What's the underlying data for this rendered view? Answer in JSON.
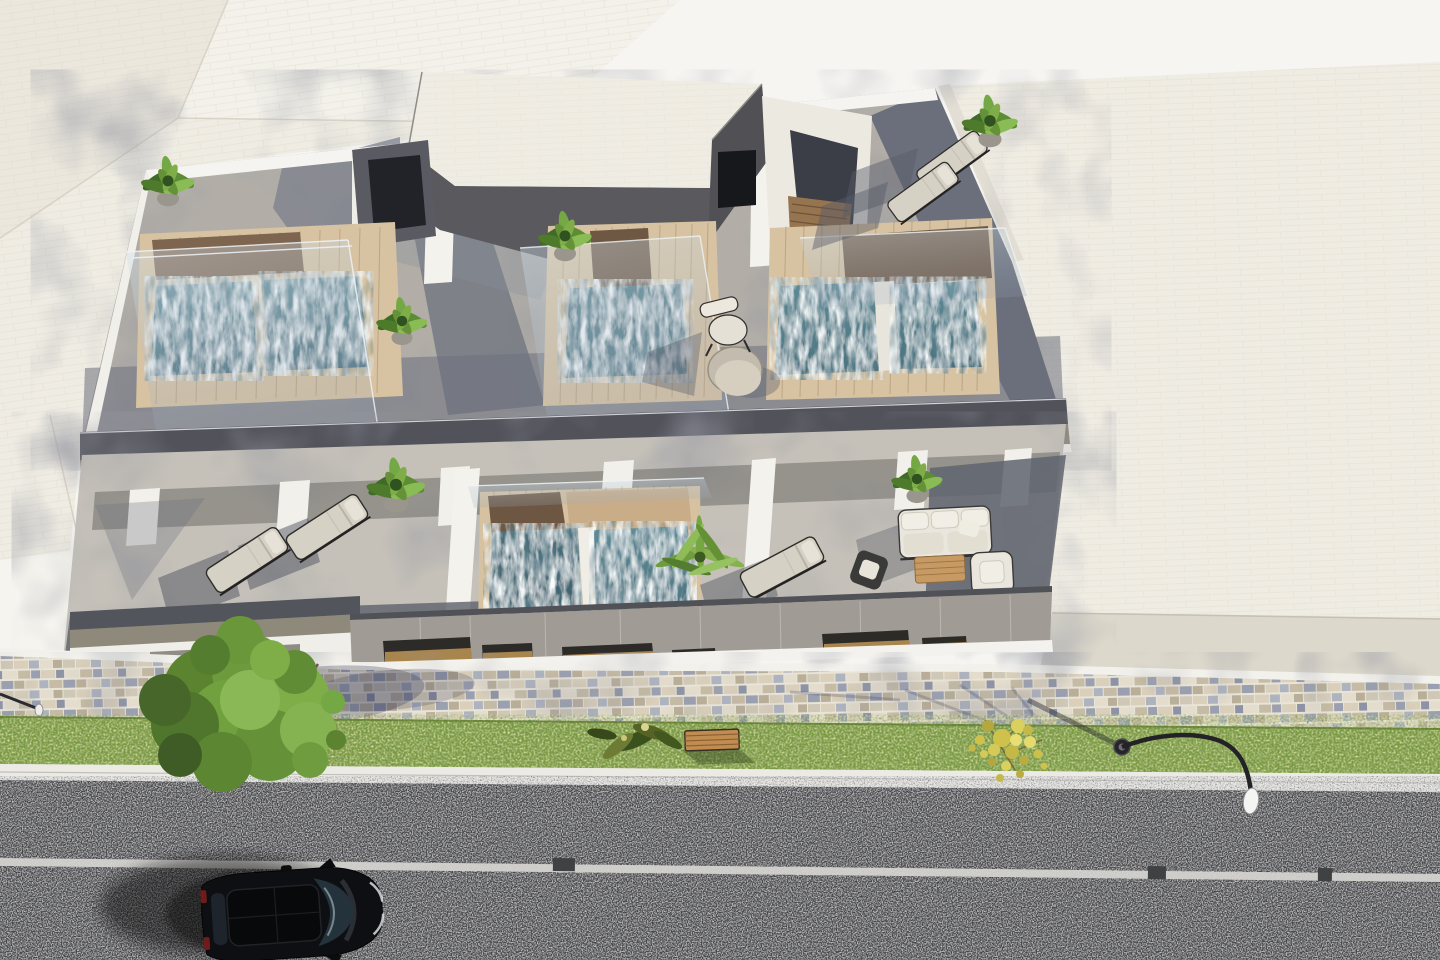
{
  "scene": {
    "type": "architectural-3d-render",
    "view": "aerial-top-down",
    "subject": "modern-apartment-building-with-rooftop-plunge-pools",
    "time_of_day": "daylight",
    "street_side": "bottom"
  },
  "palette": {
    "background": "#f6f5f2",
    "neighbor_roof": "#efece3",
    "roof_terrace": "#b2aea7",
    "lower_terrace": "#c5c1b9",
    "shadow_slate": "#6d717e",
    "pool_deck": "#d7c2a1",
    "pool_water": "#507b87",
    "wood_dark": "#7e6550",
    "fascia_olive": "#8e897a",
    "facade_gray": "#a09b94",
    "wall_white": "#f3f1ec",
    "sidewalk_grout": "#e9e4d8",
    "mosaic_blue": "#9aa0b0",
    "mosaic_tan": "#c6bba4",
    "grass": "#7b9b3f",
    "curb": "#ebeae5",
    "road": "#404143",
    "lane_line": "#d6d5d1",
    "car_body": "#0e0f12",
    "bench_wood": "#c08c4f",
    "tree_green": "#6d9a3c",
    "tree_yellow": "#cfc14c",
    "glass": "#cfe0e8"
  },
  "inventory": {
    "rooftop_plunge_pools": 5,
    "terrace_plunge_pools": 2,
    "glass_balustrades": 5,
    "sun_loungers": 5,
    "potted_plants": 7,
    "palm_plants": 1,
    "outdoor_sofas": 1,
    "armchairs": 1,
    "side_chairs": 1,
    "coffee_tables": 1,
    "round_tables": 1,
    "terrace_chairs": 1,
    "stair_bulkheads": 3,
    "park_benches": 1,
    "street_lamps": 2,
    "cars": 1,
    "green_trees": 1,
    "yellow_trees": 1,
    "neighbor_rooftops": 2
  }
}
